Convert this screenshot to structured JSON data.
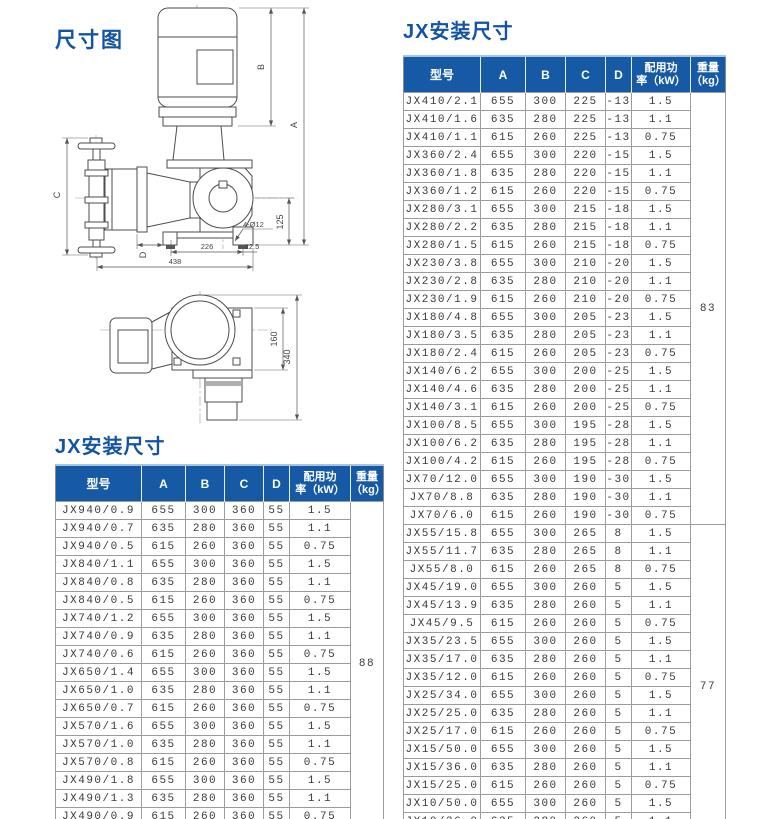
{
  "diagram": {
    "title": "尺寸图",
    "labels": {
      "A": "A",
      "B": "B",
      "C": "C",
      "D": "D",
      "holes": "4-Ø12",
      "h125": "125",
      "w226": "226",
      "w12_5": "12.5",
      "w438": "438",
      "h160": "160",
      "h340": "340"
    }
  },
  "left_table": {
    "title": "JX安装尺寸",
    "headers": {
      "model": "型号",
      "a": "A",
      "b": "B",
      "c": "C",
      "d": "D",
      "power_line1": "配用功",
      "power_line2": "率（kW）",
      "weight_line1": "重量",
      "weight_line2": "（kg）"
    },
    "rows": [
      [
        "JX940/0.9",
        "655",
        "300",
        "360",
        "55",
        "1.5"
      ],
      [
        "JX940/0.7",
        "635",
        "280",
        "360",
        "55",
        "1.1"
      ],
      [
        "JX940/0.5",
        "615",
        "260",
        "360",
        "55",
        "0.75"
      ],
      [
        "JX840/1.1",
        "655",
        "300",
        "360",
        "55",
        "1.5"
      ],
      [
        "JX840/0.8",
        "635",
        "280",
        "360",
        "55",
        "1.1"
      ],
      [
        "JX840/0.5",
        "615",
        "260",
        "360",
        "55",
        "0.75"
      ],
      [
        "JX740/1.2",
        "655",
        "300",
        "360",
        "55",
        "1.5"
      ],
      [
        "JX740/0.9",
        "635",
        "280",
        "360",
        "55",
        "1.1"
      ],
      [
        "JX740/0.6",
        "615",
        "260",
        "360",
        "55",
        "0.75"
      ],
      [
        "JX650/1.4",
        "655",
        "300",
        "360",
        "55",
        "1.5"
      ],
      [
        "JX650/1.0",
        "635",
        "280",
        "360",
        "55",
        "1.1"
      ],
      [
        "JX650/0.7",
        "615",
        "260",
        "360",
        "55",
        "0.75"
      ],
      [
        "JX570/1.6",
        "655",
        "300",
        "360",
        "55",
        "1.5"
      ],
      [
        "JX570/1.0",
        "635",
        "280",
        "360",
        "55",
        "1.1"
      ],
      [
        "JX570/0.8",
        "615",
        "260",
        "360",
        "55",
        "0.75"
      ],
      [
        "JX490/1.8",
        "655",
        "300",
        "360",
        "55",
        "1.5"
      ],
      [
        "JX490/1.3",
        "635",
        "280",
        "360",
        "55",
        "1.1"
      ],
      [
        "JX490/0.9",
        "615",
        "260",
        "360",
        "55",
        "0.75"
      ]
    ],
    "weight_groups": [
      {
        "weight": "88",
        "span": 18
      }
    ]
  },
  "right_table": {
    "title": "JX安装尺寸",
    "headers": {
      "model": "型号",
      "a": "A",
      "b": "B",
      "c": "C",
      "d": "D",
      "power_line1": "配用功",
      "power_line2": "率（kW）",
      "weight_line1": "重量",
      "weight_line2": "（kg）"
    },
    "rows": [
      [
        "JX410/2.1",
        "655",
        "300",
        "225",
        "-13",
        "1.5"
      ],
      [
        "JX410/1.6",
        "635",
        "280",
        "225",
        "-13",
        "1.1"
      ],
      [
        "JX410/1.1",
        "615",
        "260",
        "225",
        "-13",
        "0.75"
      ],
      [
        "JX360/2.4",
        "655",
        "300",
        "220",
        "-15",
        "1.5"
      ],
      [
        "JX360/1.8",
        "635",
        "280",
        "220",
        "-15",
        "1.1"
      ],
      [
        "JX360/1.2",
        "615",
        "260",
        "220",
        "-15",
        "0.75"
      ],
      [
        "JX280/3.1",
        "655",
        "300",
        "215",
        "-18",
        "1.5"
      ],
      [
        "JX280/2.2",
        "635",
        "280",
        "215",
        "-18",
        "1.1"
      ],
      [
        "JX280/1.5",
        "615",
        "260",
        "215",
        "-18",
        "0.75"
      ],
      [
        "JX230/3.8",
        "655",
        "300",
        "210",
        "-20",
        "1.5"
      ],
      [
        "JX230/2.8",
        "635",
        "280",
        "210",
        "-20",
        "1.1"
      ],
      [
        "JX230/1.9",
        "615",
        "260",
        "210",
        "-20",
        "0.75"
      ],
      [
        "JX180/4.8",
        "655",
        "300",
        "205",
        "-23",
        "1.5"
      ],
      [
        "JX180/3.5",
        "635",
        "280",
        "205",
        "-23",
        "1.1"
      ],
      [
        "JX180/2.4",
        "615",
        "260",
        "205",
        "-23",
        "0.75"
      ],
      [
        "JX140/6.2",
        "655",
        "300",
        "200",
        "-25",
        "1.5"
      ],
      [
        "JX140/4.6",
        "635",
        "280",
        "200",
        "-25",
        "1.1"
      ],
      [
        "JX140/3.1",
        "615",
        "260",
        "200",
        "-25",
        "0.75"
      ],
      [
        "JX100/8.5",
        "655",
        "300",
        "195",
        "-28",
        "1.5"
      ],
      [
        "JX100/6.2",
        "635",
        "280",
        "195",
        "-28",
        "1.1"
      ],
      [
        "JX100/4.2",
        "615",
        "260",
        "195",
        "-28",
        "0.75"
      ],
      [
        "JX70/12.0",
        "655",
        "300",
        "190",
        "-30",
        "1.5"
      ],
      [
        "JX70/8.8",
        "635",
        "280",
        "190",
        "-30",
        "1.1"
      ],
      [
        "JX70/6.0",
        "615",
        "260",
        "190",
        "-30",
        "0.75"
      ],
      [
        "JX55/15.8",
        "655",
        "300",
        "265",
        "8",
        "1.5"
      ],
      [
        "JX55/11.7",
        "635",
        "280",
        "265",
        "8",
        "1.1"
      ],
      [
        "JX55/8.0",
        "615",
        "260",
        "265",
        "8",
        "0.75"
      ],
      [
        "JX45/19.0",
        "655",
        "300",
        "260",
        "5",
        "1.5"
      ],
      [
        "JX45/13.9",
        "635",
        "280",
        "260",
        "5",
        "1.1"
      ],
      [
        "JX45/9.5",
        "615",
        "260",
        "260",
        "5",
        "0.75"
      ],
      [
        "JX35/23.5",
        "655",
        "300",
        "260",
        "5",
        "1.5"
      ],
      [
        "JX35/17.0",
        "635",
        "280",
        "260",
        "5",
        "1.1"
      ],
      [
        "JX35/12.0",
        "615",
        "260",
        "260",
        "5",
        "0.75"
      ],
      [
        "JX25/34.0",
        "655",
        "300",
        "260",
        "5",
        "1.5"
      ],
      [
        "JX25/25.0",
        "635",
        "280",
        "260",
        "5",
        "1.1"
      ],
      [
        "JX25/17.0",
        "615",
        "260",
        "260",
        "5",
        "0.75"
      ],
      [
        "JX15/50.0",
        "655",
        "300",
        "260",
        "5",
        "1.5"
      ],
      [
        "JX15/36.0",
        "635",
        "280",
        "260",
        "5",
        "1.1"
      ],
      [
        "JX15/25.0",
        "615",
        "260",
        "260",
        "5",
        "0.75"
      ],
      [
        "JX10/50.0",
        "655",
        "300",
        "260",
        "5",
        "1.5"
      ],
      [
        "JX10/36.0",
        "635",
        "280",
        "260",
        "5",
        "1.1"
      ],
      [
        "JX10/25.0",
        "615",
        "260",
        "260",
        "5",
        "0.75"
      ]
    ],
    "weight_groups": [
      {
        "weight": "83",
        "span": 24
      },
      {
        "weight": "77",
        "span": 18
      }
    ]
  },
  "colors": {
    "header_bg": "#1659a5",
    "title_blue": "#1254a3",
    "header_top_edge": "#a6c4e4",
    "table_border": "#9b9b9b",
    "text": "#3a3a3a"
  }
}
